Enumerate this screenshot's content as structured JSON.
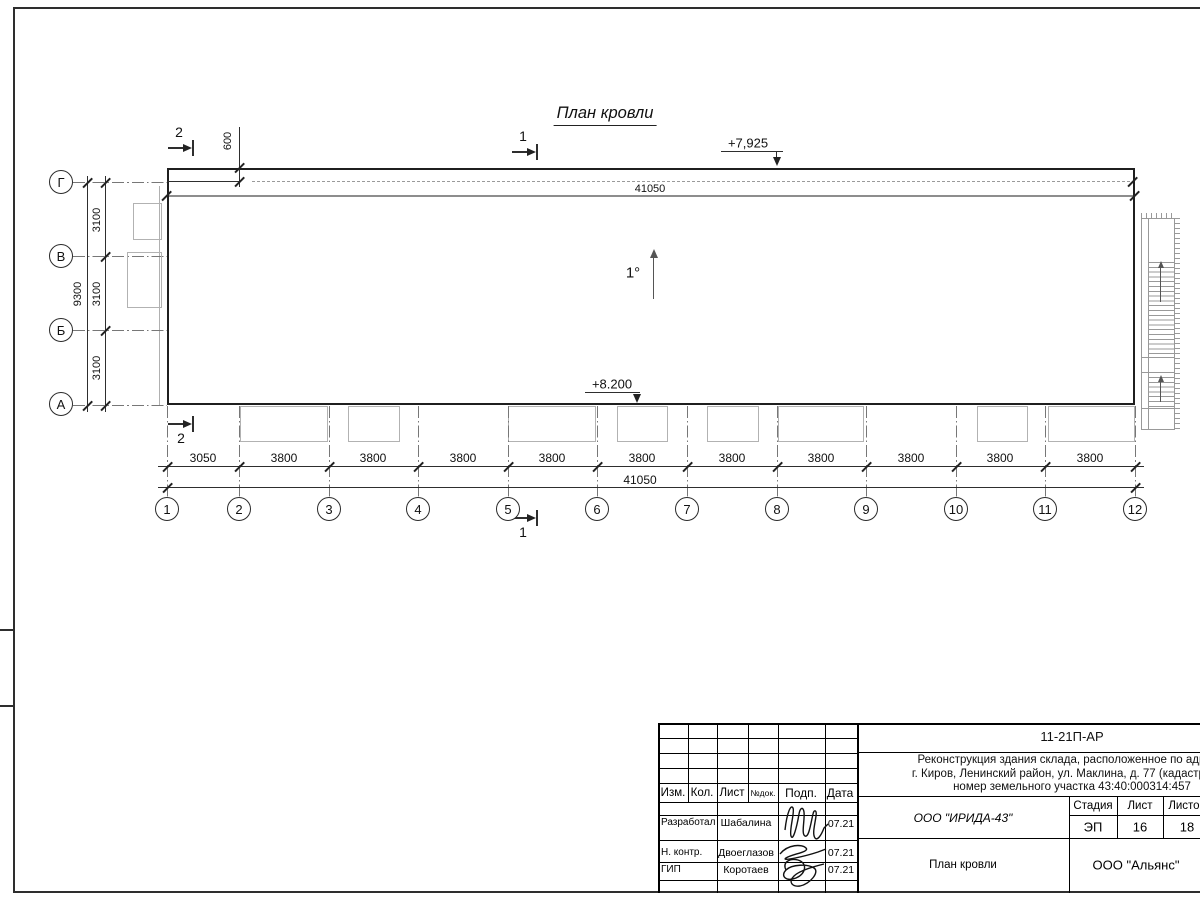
{
  "drawing": {
    "title": "План кровли",
    "slope_label": "1°",
    "elevation_top": "+7,925",
    "elevation_bottom": "+8.200",
    "dim_top_total": "41050",
    "dim_overhang": "600",
    "dim_bottom_total": "41050",
    "dim_left_total": "9300",
    "dim_left_segments": [
      "3100",
      "3100",
      "3100"
    ],
    "dim_bottom_segments": [
      "3050",
      "3800",
      "3800",
      "3800",
      "3800",
      "3800",
      "3800",
      "3800",
      "3800",
      "3800",
      "3800"
    ],
    "grid_columns": [
      "1",
      "2",
      "3",
      "4",
      "5",
      "6",
      "7",
      "8",
      "9",
      "10",
      "11",
      "12"
    ],
    "grid_rows": [
      "Г",
      "В",
      "Б",
      "А"
    ],
    "section_1": "1",
    "section_2": "2"
  },
  "title_block": {
    "doc_number": "11-21П-АР",
    "project_description": [
      "Реконструкция здания склада, расположенное по адресу:",
      "г. Киров, Ленинский район, ул. Маклина, д. 77 (кадастровый",
      "номер земельного участка 43:40:000314:457"
    ],
    "header_cols": [
      "Изм.",
      "Кол.",
      "Лист",
      "№док.",
      "Подп.",
      "Дата"
    ],
    "signature_rows": [
      {
        "role": "Разработал",
        "name": "Шабалина",
        "date": "07.21"
      },
      {
        "role": "Н. контр.",
        "name": "Двоеглазов",
        "date": "07.21"
      },
      {
        "role": "ГИП",
        "name": "Коротаев",
        "date": "07.21"
      }
    ],
    "designer_org": "ООО \"ИРИДА-43\"",
    "stage_label": "Стадия",
    "sheet_label": "Лист",
    "sheets_label": "Листов",
    "stage_value": "ЭП",
    "sheet_value": "16",
    "sheets_value": "18",
    "sheet_title": "План кровли",
    "contractor_org": "ООО \"Альянс\""
  }
}
